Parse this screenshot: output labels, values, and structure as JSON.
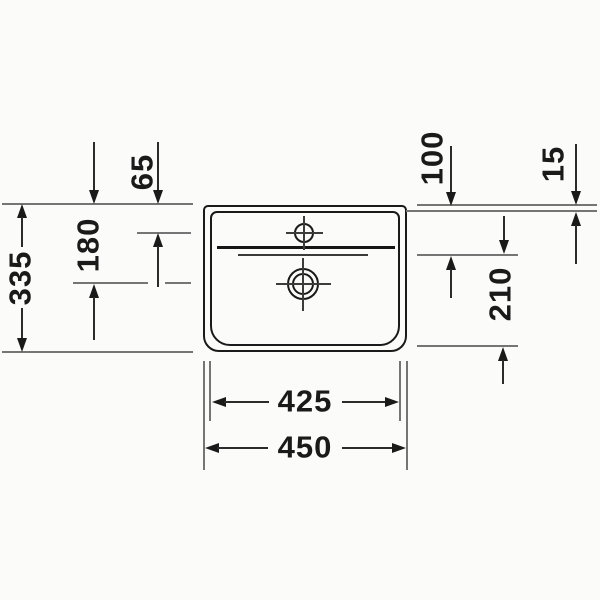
{
  "dims": {
    "d65": "65",
    "d180": "180",
    "d335": "335",
    "d100": "100",
    "d15": "15",
    "d210": "210",
    "d425": "425",
    "d450": "450"
  },
  "colors": {
    "line": "#1a1a1a",
    "ref": "#757575",
    "background": "#fbfbfa"
  }
}
